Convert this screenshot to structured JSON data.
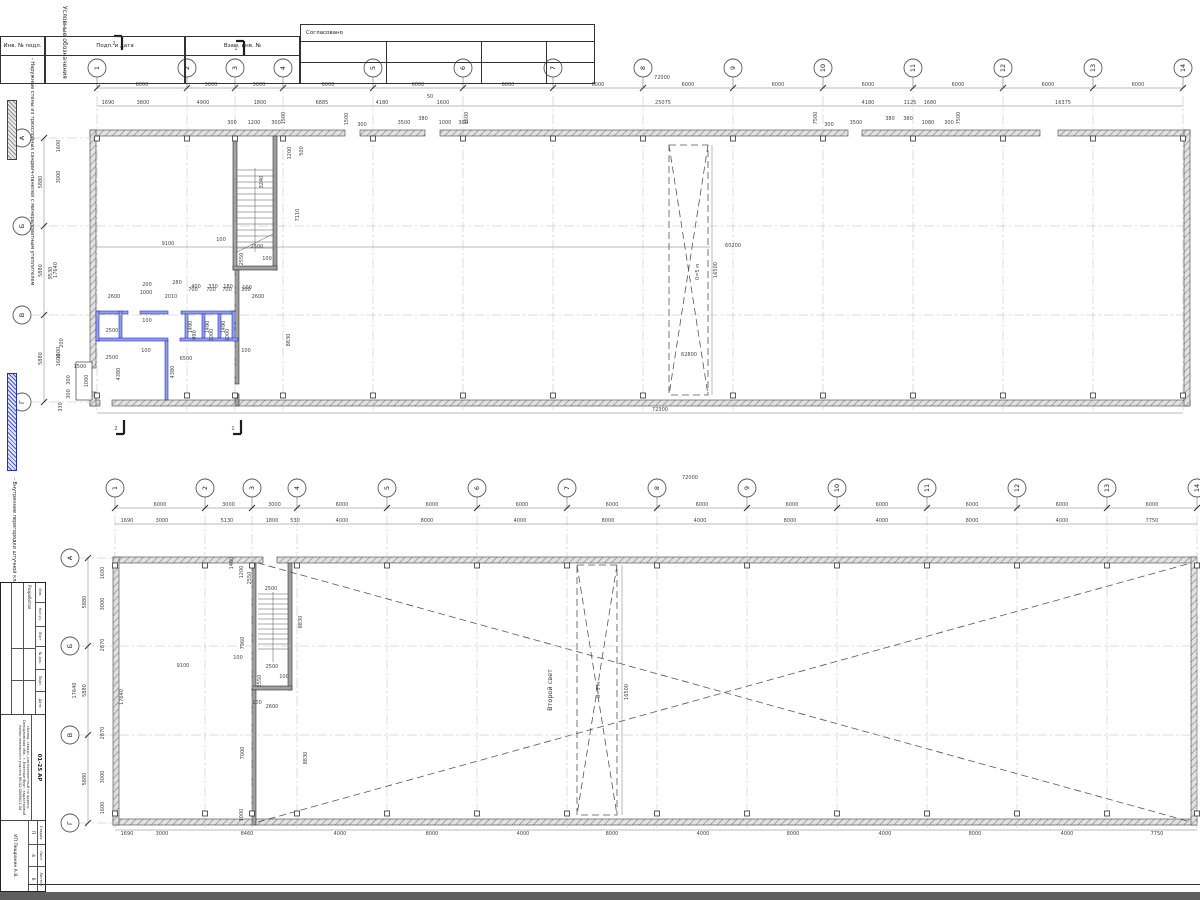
{
  "sheet": {
    "top_strip": {
      "col1": "Инв. № подл.",
      "col2": "Подп. и дата",
      "col3": "Взам. инв. №",
      "approved": "Согласовано"
    },
    "legend_title": "Условные обозначения",
    "legend_item1": "- Наружные стены из трехслойных сэндвич-панелей с минераловатным утеплителем",
    "legend_item2": "- Внутренние перегородки штучной кладки",
    "stamp": {
      "cols": [
        "Изм.",
        "Кол.уч.",
        "Лист",
        "№ док.",
        "Подп.",
        "Дата"
      ],
      "row_role": "Разработал",
      "doc_no": "01-25 АР",
      "object_text": "«Холод. склад», расположенный по адресу: Свердловская обл., г. Екатеринбург, кадастровый номер земельного участка 66:41:0508011:34",
      "company": "ИП Пищронин А.В.",
      "stage_label": "Стадия",
      "list_label": "Лист",
      "lists_label": "Листов",
      "stage": "П",
      "list_no": "4",
      "lists": "6"
    }
  },
  "plan1": {
    "axes_h": [
      "1",
      "2",
      "3",
      "4",
      "5",
      "6",
      "7",
      "8",
      "9",
      "10",
      "11",
      "12",
      "13",
      "14"
    ],
    "axes_v": [
      "А",
      "Б",
      "В",
      "Г"
    ],
    "span_dims": [
      "6000",
      "3000",
      "3000",
      "6000",
      "6000",
      "6000",
      "6000",
      "6000",
      "6000",
      "6000",
      "6000",
      "6000",
      "6000"
    ],
    "total_top": "72000",
    "sub_dims": [
      "1690",
      "3800",
      "4900",
      "1800",
      "6885",
      "4180",
      "1600",
      "25075",
      "4180",
      "1125",
      "1680",
      "16375"
    ],
    "small_dims": [
      "300",
      "1200",
      "300",
      "1500",
      "1500",
      "300",
      "3500",
      "380",
      "1000",
      "300",
      "1500",
      "7500",
      "300",
      "3500",
      "380",
      "380",
      "1080",
      "300",
      "7500",
      "50"
    ],
    "left_spans": [
      "5880",
      "5880",
      "5880"
    ],
    "left_total": "17640",
    "left_subs": [
      "1600",
      "3000",
      "9530",
      "1600"
    ],
    "left_small": [
      "1500",
      "300",
      "1000",
      "300",
      "330",
      "200",
      "1600"
    ],
    "bottom_total": "72300",
    "section_marks": [
      "2",
      "1",
      "2",
      "1"
    ],
    "ann": [
      "9100",
      "2500",
      "100",
      "3240",
      "1200",
      "500",
      "7110",
      "2550",
      "100",
      "2600",
      "100",
      "200",
      "280",
      "400",
      "330",
      "180",
      "2600",
      "1000",
      "2010",
      "700",
      "700",
      "700",
      "100",
      "1490",
      "1490",
      "1490",
      "990",
      "1000",
      "1000",
      "2500",
      "100",
      "2500",
      "100",
      "6500",
      "100",
      "4380",
      "4380",
      "8830",
      "60200",
      "16500",
      "0=5 м",
      "62800"
    ]
  },
  "plan2": {
    "axes_h": [
      "1",
      "2",
      "3",
      "4",
      "5",
      "6",
      "7",
      "8",
      "9",
      "10",
      "11",
      "12",
      "13",
      "14"
    ],
    "axes_v": [
      "А",
      "Б",
      "В",
      "Г"
    ],
    "span_dims": [
      "6000",
      "3000",
      "3000",
      "6000",
      "6000",
      "6000",
      "6000",
      "6000",
      "6000",
      "6000",
      "6000",
      "6000",
      "6000"
    ],
    "total_top": "72000",
    "sub_dims": [
      "1690",
      "3000",
      "5130",
      "1800",
      "530",
      "4000",
      "8000",
      "4000",
      "8000",
      "4000",
      "8000",
      "4000",
      "8000",
      "4000",
      "7750"
    ],
    "bottom_dims": [
      "1690",
      "3000",
      "8460",
      "4000",
      "8000",
      "4000",
      "8000",
      "4000",
      "8000",
      "4000",
      "8000",
      "4000",
      "7750"
    ],
    "left_spans": [
      "5880",
      "5880",
      "5880"
    ],
    "left_total": "17640",
    "left_subs": [
      "1600",
      "3000",
      "2870",
      "2870",
      "3000",
      "1600"
    ],
    "second_light": "Второй свет",
    "ann": [
      "1480",
      "1200",
      "2550",
      "2500",
      "7960",
      "8830",
      "100",
      "2500",
      "2550",
      "100",
      "2600",
      "100",
      "7000",
      "8830",
      "1000",
      "9100",
      "0=5 м",
      "16500",
      "17640"
    ]
  }
}
